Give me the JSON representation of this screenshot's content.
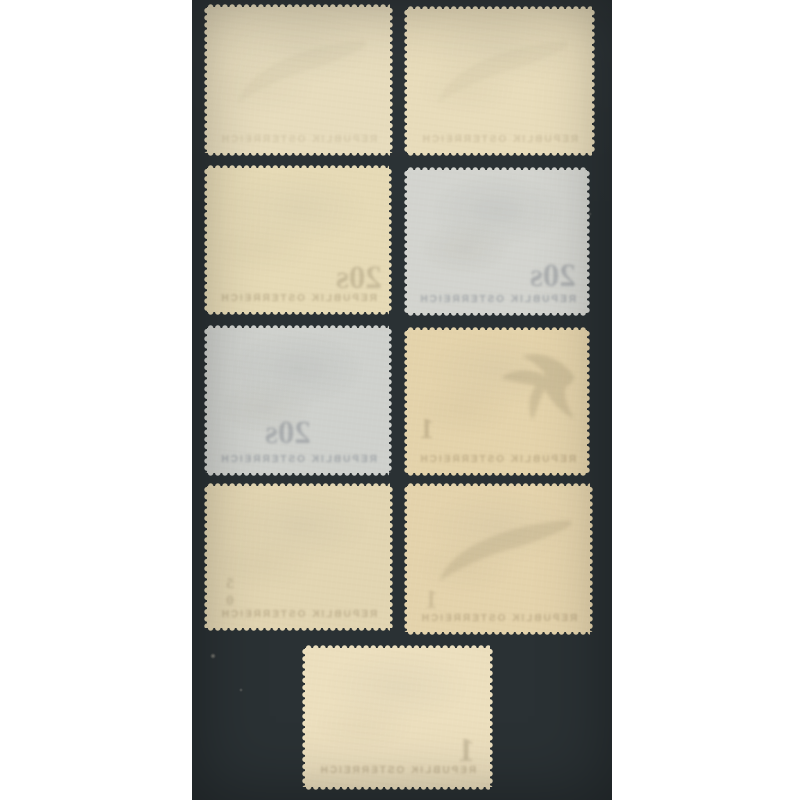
{
  "scene": {
    "subject": "Nine mint postage stamps photographed from the gum side on a dark board",
    "arrangement": "Four rows of two stamps plus one single stamp centred at the bottom",
    "stamp_count": 9,
    "background_color": "#2a3134",
    "margin_color": "#ffffff"
  },
  "ghost": {
    "band_text": "REPUBLIK OSTERREICH"
  },
  "stamps": [
    {
      "name": "stamp-back-row1-left",
      "tone": "cream",
      "paper_color": "#e7dcbd",
      "ghost_value": ""
    },
    {
      "name": "stamp-back-row1-right",
      "tone": "cream",
      "paper_color": "#e8dcbb",
      "ghost_value": ""
    },
    {
      "name": "stamp-back-row2-left",
      "tone": "cream",
      "paper_color": "#e6dab6",
      "ghost_value": "20s"
    },
    {
      "name": "stamp-back-row2-right",
      "tone": "grey",
      "paper_color": "#d3d4cf",
      "ghost_value": "20s"
    },
    {
      "name": "stamp-back-row3-left",
      "tone": "grey",
      "paper_color": "#cfd1cd",
      "ghost_value": "20s"
    },
    {
      "name": "stamp-back-row3-right",
      "tone": "cream",
      "paper_color": "#e4d3ab",
      "ghost_value": "1"
    },
    {
      "name": "stamp-back-row4-left",
      "tone": "cream",
      "paper_color": "#e2d5b2",
      "ghost_value": "50"
    },
    {
      "name": "stamp-back-row4-right",
      "tone": "cream",
      "paper_color": "#e4d3ac",
      "ghost_value": "1"
    },
    {
      "name": "stamp-back-row5-center",
      "tone": "cream",
      "paper_color": "#ecdfbe",
      "ghost_value": "1"
    }
  ]
}
